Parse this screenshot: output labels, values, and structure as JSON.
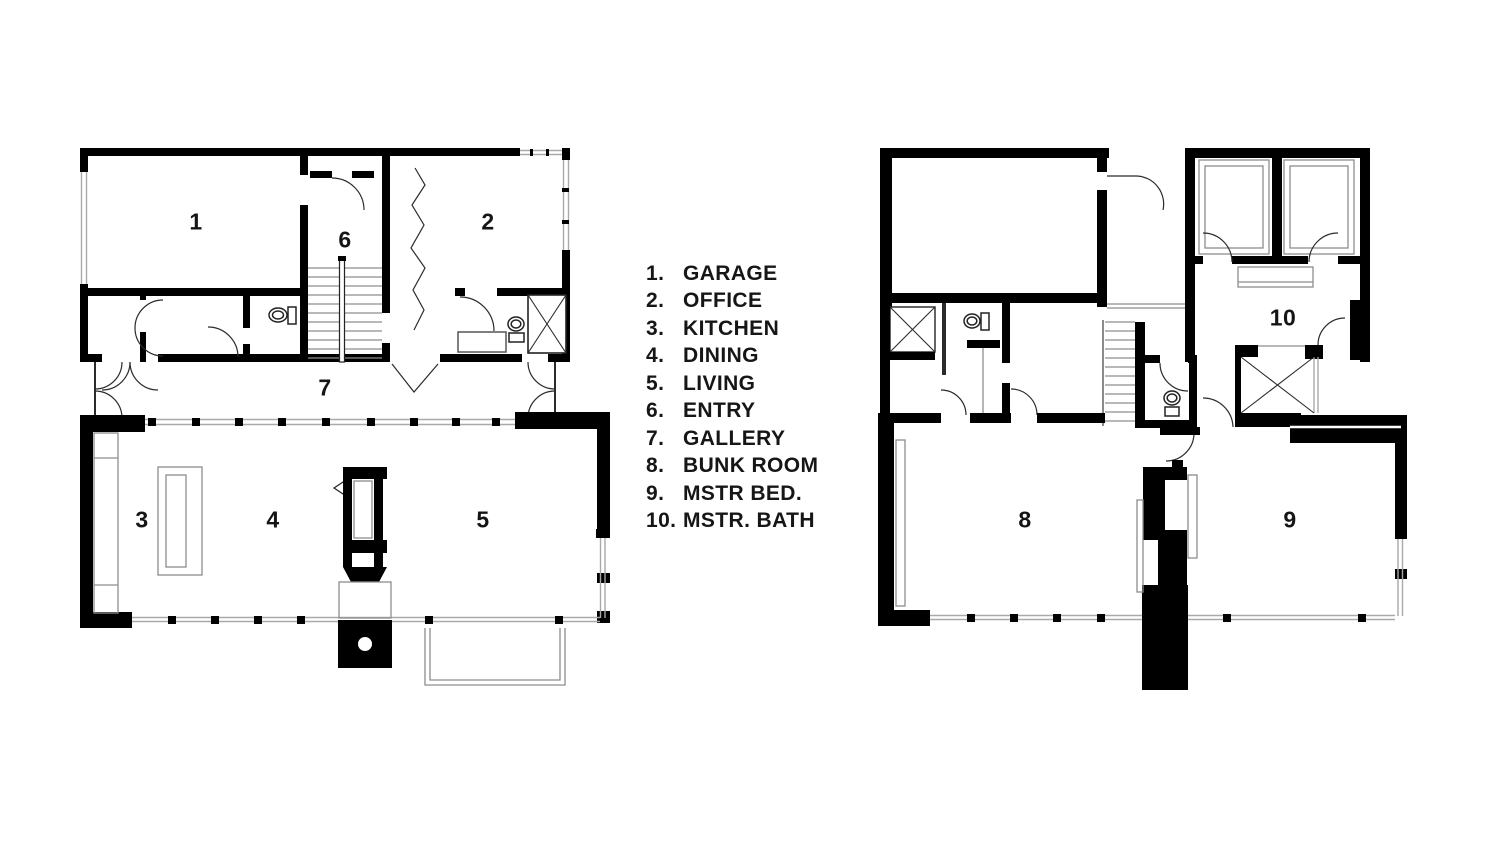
{
  "page": {
    "title": "House floor plans",
    "background": "#ffffff"
  },
  "colors": {
    "wall": "#000000",
    "thin_line": "#2b2b2b",
    "window_line": "#a9a9a9",
    "label": "#151515"
  },
  "legend": {
    "items": [
      {
        "num": "1.",
        "label": "GARAGE"
      },
      {
        "num": "2.",
        "label": "OFFICE"
      },
      {
        "num": "3.",
        "label": "KITCHEN"
      },
      {
        "num": "4.",
        "label": "DINING"
      },
      {
        "num": "5.",
        "label": "LIVING"
      },
      {
        "num": "6.",
        "label": "ENTRY"
      },
      {
        "num": "7.",
        "label": "GALLERY"
      },
      {
        "num": "8.",
        "label": "BUNK ROOM"
      },
      {
        "num": "9.",
        "label": "MSTR BED."
      },
      {
        "num": "10.",
        "label": "MSTR. BATH"
      }
    ]
  },
  "floor1": {
    "rooms": {
      "garage": "1",
      "office": "2",
      "kitchen": "3",
      "dining": "4",
      "living": "5",
      "entry": "6",
      "gallery": "7"
    }
  },
  "floor2": {
    "rooms": {
      "bunk_room": "8",
      "master_bed": "9",
      "master_bath": "10"
    }
  }
}
